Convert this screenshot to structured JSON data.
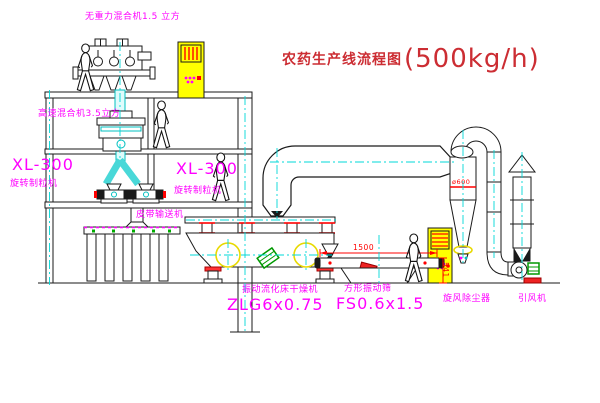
{
  "title": {
    "cn": "农药生产线流程图",
    "capacity": "(500kg/h)"
  },
  "labels": {
    "gravity_mixer": "无重力混合机1.5 立方",
    "high_speed_mixer": "高速混合机3.5立方",
    "granulator_left_model": "XL-300",
    "granulator_left_name": "旋转制粒机",
    "granulator_right_model": "XL-300",
    "granulator_right_name": "旋转制粒机",
    "belt_conveyor": "皮带输送机",
    "dryer_name": "振动流化床干燥机",
    "dryer_model": "ZLG6x0.75",
    "sieve_name": "方形振动筛",
    "sieve_model": "FS0.6x1.5",
    "cyclone": "旋风除尘器",
    "fan": "引风机"
  },
  "dimensions": {
    "sieve_length": "1500",
    "sieve_height": "541",
    "cyclone_diameter": "ø600"
  },
  "colors": {
    "label_magenta": "#ff00ff",
    "annotation_red": "#ff0000",
    "title_red": "#cc2d33",
    "cabinet_yellow": "#ffff00",
    "centerline_cyan": "#00d8d8",
    "motor_green": "#009900"
  }
}
